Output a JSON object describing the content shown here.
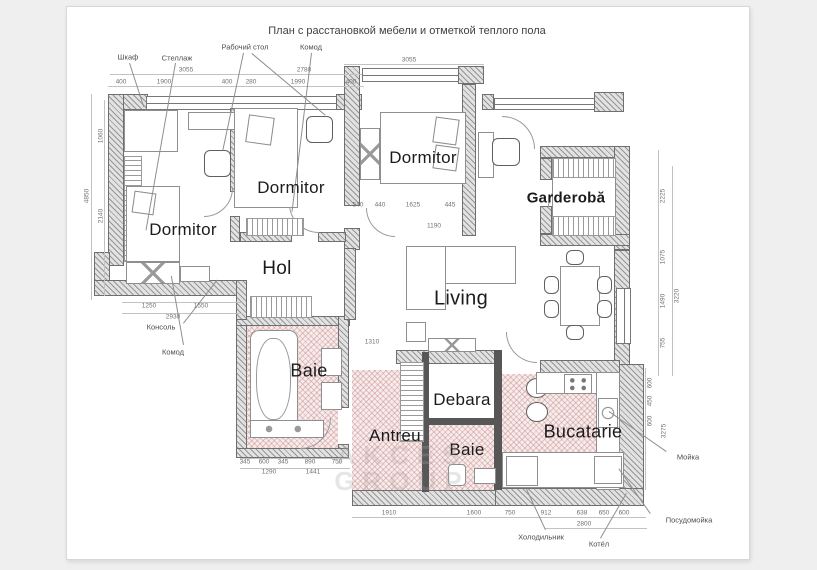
{
  "page": {
    "title": "План с расстановкой мебели и отметкой теплого пола"
  },
  "rooms": {
    "dormitor1": "Dormitor",
    "dormitor2": "Dormitor",
    "dormitor3": "Dormitor",
    "garderoba": "Garderobă",
    "hol": "Hol",
    "living": "Living",
    "baie": "Baie",
    "debara": "Debara",
    "antreu": "Antreu",
    "baie2": "Baie",
    "bucatarie": "Bucatarie"
  },
  "watermark": {
    "line1": "AKCES",
    "line2": "GROUP"
  },
  "colors": {
    "heated_floor": "#e8c9c9",
    "wall_fill": "#e2e2e2",
    "wall_line": "#6f6f6f",
    "dimension_text": "#707070",
    "label_text": "#1b1b1b"
  },
  "labels": [
    {
      "k": "dim",
      "t": "3055",
      "x": 186,
      "y": 70
    },
    {
      "k": "dim",
      "t": "2780",
      "x": 304,
      "y": 70
    },
    {
      "k": "dim",
      "t": "400",
      "x": 121,
      "y": 82
    },
    {
      "k": "dim",
      "t": "1900",
      "x": 164,
      "y": 82
    },
    {
      "k": "dim",
      "t": "400",
      "x": 227,
      "y": 82
    },
    {
      "k": "dim",
      "t": "280",
      "x": 251,
      "y": 82
    },
    {
      "k": "dim",
      "t": "1990",
      "x": 298,
      "y": 82
    },
    {
      "k": "dim",
      "t": "400",
      "x": 351,
      "y": 82
    },
    {
      "k": "dim",
      "t": "3055",
      "x": 409,
      "y": 60
    },
    {
      "k": "dim",
      "t": "1060",
      "x": 101,
      "y": 136,
      "r": 1
    },
    {
      "k": "dim",
      "t": "2140",
      "x": 101,
      "y": 216,
      "r": 1
    },
    {
      "k": "dim",
      "t": "4850",
      "x": 87,
      "y": 196,
      "r": 1
    },
    {
      "k": "dim",
      "t": "540",
      "x": 358,
      "y": 205
    },
    {
      "k": "dim",
      "t": "440",
      "x": 380,
      "y": 205
    },
    {
      "k": "dim",
      "t": "1625",
      "x": 413,
      "y": 205
    },
    {
      "k": "dim",
      "t": "445",
      "x": 450,
      "y": 205
    },
    {
      "k": "dim",
      "t": "1190",
      "x": 434,
      "y": 226
    },
    {
      "k": "dim",
      "t": "2225",
      "x": 663,
      "y": 196,
      "r": 1
    },
    {
      "k": "dim",
      "t": "1075",
      "x": 663,
      "y": 257,
      "r": 1
    },
    {
      "k": "dim",
      "t": "1490",
      "x": 663,
      "y": 301,
      "r": 1
    },
    {
      "k": "dim",
      "t": "755",
      "x": 663,
      "y": 343,
      "r": 1
    },
    {
      "k": "dim",
      "t": "3220",
      "x": 677,
      "y": 296,
      "r": 1
    },
    {
      "k": "dim",
      "t": "1250",
      "x": 149,
      "y": 306
    },
    {
      "k": "dim",
      "t": "1550",
      "x": 201,
      "y": 306
    },
    {
      "k": "dim",
      "t": "2930",
      "x": 173,
      "y": 317
    },
    {
      "k": "dim",
      "t": "1310",
      "x": 372,
      "y": 342
    },
    {
      "k": "dim",
      "t": "345",
      "x": 245,
      "y": 462
    },
    {
      "k": "dim",
      "t": "600",
      "x": 264,
      "y": 462
    },
    {
      "k": "dim",
      "t": "345",
      "x": 283,
      "y": 462
    },
    {
      "k": "dim",
      "t": "890",
      "x": 310,
      "y": 462
    },
    {
      "k": "dim",
      "t": "750",
      "x": 337,
      "y": 462
    },
    {
      "k": "dim",
      "t": "1290",
      "x": 269,
      "y": 472
    },
    {
      "k": "dim",
      "t": "1441",
      "x": 313,
      "y": 472
    },
    {
      "k": "dim",
      "t": "1910",
      "x": 389,
      "y": 513
    },
    {
      "k": "dim",
      "t": "1600",
      "x": 474,
      "y": 513
    },
    {
      "k": "dim",
      "t": "750",
      "x": 510,
      "y": 513
    },
    {
      "k": "dim",
      "t": "912",
      "x": 546,
      "y": 513
    },
    {
      "k": "dim",
      "t": "638",
      "x": 582,
      "y": 513
    },
    {
      "k": "dim",
      "t": "650",
      "x": 604,
      "y": 513
    },
    {
      "k": "dim",
      "t": "600",
      "x": 624,
      "y": 513
    },
    {
      "k": "dim",
      "t": "2800",
      "x": 584,
      "y": 524
    },
    {
      "k": "dim",
      "t": "600",
      "x": 650,
      "y": 383,
      "r": 1
    },
    {
      "k": "dim",
      "t": "450",
      "x": 650,
      "y": 401,
      "r": 1
    },
    {
      "k": "dim",
      "t": "600",
      "x": 650,
      "y": 421,
      "r": 1
    },
    {
      "k": "dim",
      "t": "3275",
      "x": 664,
      "y": 431,
      "r": 1
    },
    {
      "k": "co",
      "t": "Шкаф",
      "x": 128,
      "y": 57
    },
    {
      "k": "co",
      "t": "Стеллаж",
      "x": 177,
      "y": 58
    },
    {
      "k": "co",
      "t": "Рабочий стол",
      "x": 245,
      "y": 47
    },
    {
      "k": "co",
      "t": "Комод",
      "x": 311,
      "y": 47
    },
    {
      "k": "co",
      "t": "Консоль",
      "x": 161,
      "y": 327
    },
    {
      "k": "co",
      "t": "Комод",
      "x": 173,
      "y": 352
    },
    {
      "k": "co",
      "t": "Мойка",
      "x": 688,
      "y": 457
    },
    {
      "k": "co",
      "t": "Посудомойка",
      "x": 689,
      "y": 520
    },
    {
      "k": "co",
      "t": "Холодильник",
      "x": 541,
      "y": 537
    },
    {
      "k": "co",
      "t": "Котёл",
      "x": 599,
      "y": 544
    }
  ]
}
